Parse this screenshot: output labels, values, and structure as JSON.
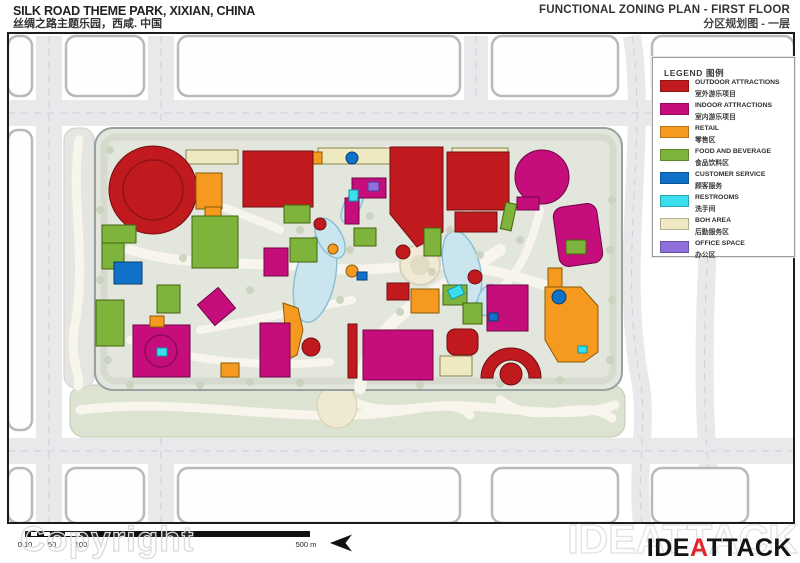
{
  "header": {
    "left_title_en": "SILK ROAD THEME PARK, XIXIAN, CHINA",
    "left_title_zh": "丝绸之路主题乐园，西咸. 中国",
    "right_title_en": "FUNCTIONAL ZONING PLAN - FIRST FLOOR",
    "right_title_zh": "分区规划图 - 一层"
  },
  "legend": {
    "title": "LEGEND 图例",
    "items": [
      {
        "zone": "outdoor",
        "label_en": "OUTDOOR ATTRACTIONS",
        "label_zh": "室外游乐项目"
      },
      {
        "zone": "indoor",
        "label_en": "INDOOR ATTRACTIONS",
        "label_zh": "室内游乐项目"
      },
      {
        "zone": "retail",
        "label_en": "RETAIL",
        "label_zh": "零售区"
      },
      {
        "zone": "fnb",
        "label_en": "FOOD AND BEVERAGE",
        "label_zh": "食品饮料区"
      },
      {
        "zone": "service",
        "label_en": "CUSTOMER SERVICE",
        "label_zh": "顾客服务"
      },
      {
        "zone": "restroom",
        "label_en": "RESTROOMS",
        "label_zh": "洗手间"
      },
      {
        "zone": "boh",
        "label_en": "BOH AREA",
        "label_zh": "后勤服务区"
      },
      {
        "zone": "office",
        "label_en": "OFFICE SPACE",
        "label_zh": "办公区"
      }
    ]
  },
  "zones": {
    "outdoor": {
      "fill": "#c11a1e",
      "stroke": "#6f0f11"
    },
    "indoor": {
      "fill": "#c50d7b",
      "stroke": "#6e0545"
    },
    "retail": {
      "fill": "#f5991f",
      "stroke": "#8a5a08"
    },
    "fnb": {
      "fill": "#7eb43b",
      "stroke": "#44650f"
    },
    "service": {
      "fill": "#0f72c8",
      "stroke": "#073f73"
    },
    "restroom": {
      "fill": "#3adeec",
      "stroke": "#0d96a5"
    },
    "boh": {
      "fill": "#efe9c1",
      "stroke": "#8a8454"
    },
    "office": {
      "fill": "#8f6fdb",
      "stroke": "#4f3795"
    }
  },
  "scale_bar": {
    "bar": {
      "x1": 25,
      "x2": 310,
      "y": 531,
      "h": 6,
      "notches": [
        [
          31,
          37
        ],
        [
          44,
          50
        ],
        [
          65,
          80
        ]
      ]
    },
    "labels": [
      {
        "text": "0 10",
        "x": 25
      },
      {
        "text": "50",
        "x": 52
      },
      {
        "text": "100",
        "x": 81
      },
      {
        "text": "500 m",
        "x": 306
      }
    ]
  },
  "footer": {
    "copyright_watermark": "Copyright",
    "logo_watermark": "IDEATTACK",
    "logo": {
      "prefix": "IDE",
      "accent": "A",
      "suffix": "TTACK"
    }
  },
  "map": {
    "colors": {
      "frame": "#1c1c1c",
      "road": "#e9e9eb",
      "road_dash": "#cfcfd4",
      "block_fill": "#fefefe",
      "block_stroke": "#b7b9bc",
      "park_fill": "#e3e6dc",
      "park_stroke": "#98a0a0",
      "park_ring": "#d6dacf",
      "strip": "#dde3d1",
      "strip_left": "#e5e5e2",
      "swirl": "#f8f5ec",
      "lake_fill": "#cbe5ef",
      "lake_stroke": "#8cc0d6",
      "walk": "#f8f5ee",
      "plaza_fill": "#efe9d6",
      "plaza_stroke": "#d9d2ba",
      "tree": "#c9d2bb",
      "sunburst": "#efe8d2"
    },
    "frame": {
      "x": 8,
      "y": 33,
      "w": 786,
      "h": 490
    },
    "roads_h": [
      {
        "x": 8,
        "y": 100,
        "w": 786,
        "h": 26
      },
      {
        "x": 8,
        "y": 438,
        "w": 786,
        "h": 26
      }
    ],
    "roads_v": [
      {
        "x": 36,
        "y": 36,
        "w": 26,
        "h": 487
      },
      {
        "x": 148,
        "y": 36,
        "w": 26,
        "h": 90
      },
      {
        "x": 148,
        "y": 438,
        "w": 26,
        "h": 85
      },
      {
        "x": 464,
        "y": 36,
        "w": 24,
        "h": 64
      }
    ],
    "roads_curvy": [
      "M632,36 C648,140 618,260 640,380 C648,420 636,470 642,523",
      "M706,36 C726,160 688,320 714,523"
    ],
    "blocks": [
      {
        "x": 8,
        "y": 36,
        "w": 24,
        "h": 60
      },
      {
        "x": 66,
        "y": 36,
        "w": 78,
        "h": 60
      },
      {
        "x": 178,
        "y": 36,
        "w": 282,
        "h": 60
      },
      {
        "x": 492,
        "y": 36,
        "w": 126,
        "h": 60
      },
      {
        "x": 652,
        "y": 36,
        "w": 142,
        "h": 60
      },
      {
        "x": 8,
        "y": 130,
        "w": 24,
        "h": 300
      },
      {
        "x": 8,
        "y": 468,
        "w": 24,
        "h": 55
      },
      {
        "x": 66,
        "y": 468,
        "w": 78,
        "h": 55
      },
      {
        "x": 178,
        "y": 468,
        "w": 282,
        "h": 55
      },
      {
        "x": 492,
        "y": 468,
        "w": 126,
        "h": 55
      },
      {
        "x": 652,
        "y": 468,
        "w": 96,
        "h": 55
      }
    ],
    "park": {
      "x": 95,
      "y": 128,
      "w": 527,
      "h": 262,
      "r": 18
    },
    "strip_bottom": {
      "x": 70,
      "y": 385,
      "w": 555,
      "h": 52
    },
    "strip_left": {
      "x": 64,
      "y": 128,
      "w": 30,
      "h": 260
    },
    "sunburst": {
      "cx": 337,
      "cy": 406,
      "rx": 20,
      "ry": 22
    },
    "swirls": [
      "M80,410 C200,395 300,430 420,408 C480,398 560,425 615,405",
      "M340,392 C380,430 450,390 470,415",
      "M500,400 C540,430 580,395 612,418",
      "M79,140 C70,200 88,260 74,330 C70,360 82,380 78,386"
    ],
    "walks": [
      {
        "d": "M360,388 C365,350 380,330 420,300 C450,280 470,270 500,250",
        "w": 12
      },
      {
        "d": "M130,250 C200,270 260,260 320,268 C360,272 390,268 420,265",
        "w": 10
      },
      {
        "d": "M420,265 C460,262 500,270 560,290",
        "w": 10
      },
      {
        "d": "M420,265 C420,220 400,180 390,150",
        "w": 10
      },
      {
        "d": "M200,330 C260,320 300,310 352,300",
        "w": 8
      },
      {
        "d": "M480,180 C470,220 450,240 432,256",
        "w": 8
      },
      {
        "d": "M540,210 C530,250 520,270 500,290",
        "w": 8
      },
      {
        "d": "M160,180 C200,200 240,212 280,230",
        "w": 8
      },
      {
        "d": "M130,340 C180,360 260,368 330,362",
        "w": 8
      }
    ],
    "lakes": [
      {
        "cx": 315,
        "cy": 278,
        "rx": 20,
        "ry": 45,
        "rot": 12
      },
      {
        "cx": 330,
        "cy": 238,
        "rx": 12,
        "ry": 22,
        "rot": -30
      },
      {
        "cx": 462,
        "cy": 268,
        "rx": 18,
        "ry": 38,
        "rot": -14
      },
      {
        "cx": 488,
        "cy": 300,
        "rx": 10,
        "ry": 16,
        "rot": 20
      },
      {
        "cx": 352,
        "cy": 206,
        "rx": 8,
        "ry": 18,
        "rot": 28
      }
    ],
    "plaza": {
      "cx": 420,
      "cy": 265,
      "r": 20,
      "r2": 10
    },
    "trees": [
      [
        110,
        150
      ],
      [
        100,
        210
      ],
      [
        100,
        280
      ],
      [
        108,
        360
      ],
      [
        130,
        385
      ],
      [
        200,
        385
      ],
      [
        250,
        382
      ],
      [
        300,
        383
      ],
      [
        420,
        385
      ],
      [
        500,
        384
      ],
      [
        560,
        380
      ],
      [
        610,
        360
      ],
      [
        612,
        300
      ],
      [
        610,
        250
      ],
      [
        612,
        200
      ],
      [
        300,
        230
      ],
      [
        340,
        300
      ],
      [
        400,
        312
      ],
      [
        432,
        272
      ],
      [
        480,
        255
      ],
      [
        250,
        290
      ],
      [
        350,
        250
      ],
      [
        370,
        216
      ],
      [
        450,
        230
      ],
      [
        520,
        240
      ],
      [
        560,
        226
      ],
      [
        183,
        258
      ],
      [
        225,
        305
      ]
    ],
    "buildings": [
      {
        "z": "boh",
        "s": "rect",
        "x": 186,
        "y": 150,
        "w": 52,
        "h": 14
      },
      {
        "z": "boh",
        "s": "rect",
        "x": 318,
        "y": 148,
        "w": 88,
        "h": 16
      },
      {
        "z": "boh",
        "s": "rect",
        "x": 452,
        "y": 148,
        "w": 56,
        "h": 16
      },
      {
        "z": "office",
        "s": "rect",
        "x": 394,
        "y": 150,
        "w": 9,
        "h": 8
      },
      {
        "z": "office",
        "s": "rect",
        "x": 540,
        "y": 151,
        "w": 8,
        "h": 7
      },
      {
        "z": "retail",
        "s": "rect",
        "x": 310,
        "y": 152,
        "w": 12,
        "h": 12
      },
      {
        "z": "service",
        "s": "circle",
        "cx": 352,
        "cy": 158,
        "r": 6
      },
      {
        "z": "outdoor",
        "s": "circle",
        "cx": 153,
        "cy": 190,
        "r": 44
      },
      {
        "z": "outdoor",
        "s": "ring",
        "cx": 153,
        "cy": 190,
        "r": 30
      },
      {
        "z": "retail",
        "s": "rect",
        "x": 196,
        "y": 173,
        "w": 26,
        "h": 36
      },
      {
        "z": "retail",
        "s": "rect",
        "x": 205,
        "y": 207,
        "w": 16,
        "h": 16
      },
      {
        "z": "outdoor",
        "s": "rect",
        "x": 243,
        "y": 151,
        "w": 70,
        "h": 56
      },
      {
        "z": "outdoor",
        "s": "poly",
        "pts": "390,147 443,147 443,232 417,247 390,214"
      },
      {
        "z": "outdoor",
        "s": "rect",
        "x": 447,
        "y": 152,
        "w": 62,
        "h": 58
      },
      {
        "z": "outdoor",
        "s": "rect",
        "x": 455,
        "y": 212,
        "w": 42,
        "h": 20
      },
      {
        "z": "indoor",
        "s": "circle",
        "cx": 542,
        "cy": 177,
        "r": 27
      },
      {
        "z": "indoor",
        "s": "rect",
        "x": 517,
        "y": 197,
        "w": 22,
        "h": 13
      },
      {
        "z": "indoor",
        "s": "rect",
        "x": 556,
        "y": 205,
        "w": 44,
        "h": 60,
        "rx": 10,
        "rot": -8
      },
      {
        "z": "fnb",
        "s": "rect",
        "x": 503,
        "y": 203,
        "w": 11,
        "h": 27,
        "rot": 12
      },
      {
        "z": "retail",
        "s": "rect",
        "x": 548,
        "y": 268,
        "w": 14,
        "h": 20
      },
      {
        "z": "indoor",
        "s": "rect",
        "x": 352,
        "y": 178,
        "w": 34,
        "h": 20
      },
      {
        "z": "indoor",
        "s": "rect",
        "x": 345,
        "y": 198,
        "w": 14,
        "h": 26
      },
      {
        "z": "office",
        "s": "rect",
        "x": 368,
        "y": 182,
        "w": 11,
        "h": 9
      },
      {
        "z": "restroom",
        "s": "rect",
        "x": 349,
        "y": 190,
        "w": 9,
        "h": 11
      },
      {
        "z": "fnb",
        "s": "rect",
        "x": 424,
        "y": 228,
        "w": 17,
        "h": 28
      },
      {
        "z": "fnb",
        "s": "rect",
        "x": 290,
        "y": 238,
        "w": 27,
        "h": 24
      },
      {
        "z": "fnb",
        "s": "rect",
        "x": 354,
        "y": 228,
        "w": 22,
        "h": 18
      },
      {
        "z": "indoor",
        "s": "rect",
        "x": 264,
        "y": 248,
        "w": 24,
        "h": 28
      },
      {
        "z": "restroom",
        "s": "rect",
        "x": 219,
        "y": 223,
        "w": 12,
        "h": 9
      },
      {
        "z": "outdoor",
        "s": "rect",
        "x": 210,
        "y": 233,
        "w": 16,
        "h": 12
      },
      {
        "z": "outdoor",
        "s": "circle",
        "cx": 320,
        "cy": 224,
        "r": 6
      },
      {
        "z": "outdoor",
        "s": "circle",
        "cx": 403,
        "cy": 252,
        "r": 7
      },
      {
        "z": "outdoor",
        "s": "circle",
        "cx": 475,
        "cy": 277,
        "r": 7
      },
      {
        "z": "outdoor",
        "s": "circle",
        "cx": 118,
        "cy": 316,
        "r": 6
      },
      {
        "z": "fnb",
        "s": "rect",
        "x": 102,
        "y": 225,
        "w": 34,
        "h": 18
      },
      {
        "z": "fnb",
        "s": "rect",
        "x": 102,
        "y": 243,
        "w": 22,
        "h": 26
      },
      {
        "z": "fnb",
        "s": "rect",
        "x": 192,
        "y": 216,
        "w": 46,
        "h": 52
      },
      {
        "z": "service",
        "s": "rect",
        "x": 114,
        "y": 262,
        "w": 28,
        "h": 22
      },
      {
        "z": "retail",
        "s": "circle",
        "cx": 352,
        "cy": 271,
        "r": 6
      },
      {
        "z": "retail",
        "s": "circle",
        "cx": 333,
        "cy": 249,
        "r": 5
      },
      {
        "z": "service",
        "s": "rect",
        "x": 357,
        "y": 272,
        "w": 10,
        "h": 8
      },
      {
        "z": "fnb",
        "s": "rect",
        "x": 443,
        "y": 285,
        "w": 24,
        "h": 20
      },
      {
        "z": "fnb",
        "s": "rect",
        "x": 566,
        "y": 240,
        "w": 20,
        "h": 14
      },
      {
        "z": "indoor",
        "s": "rect",
        "x": 133,
        "y": 325,
        "w": 57,
        "h": 52
      },
      {
        "z": "indoor",
        "s": "ring",
        "cx": 161,
        "cy": 351,
        "r": 16
      },
      {
        "z": "restroom",
        "s": "rect",
        "x": 157,
        "y": 348,
        "w": 10,
        "h": 8
      },
      {
        "z": "fnb",
        "s": "rect",
        "x": 96,
        "y": 300,
        "w": 28,
        "h": 46
      },
      {
        "z": "fnb",
        "s": "rect",
        "x": 157,
        "y": 285,
        "w": 23,
        "h": 28
      },
      {
        "z": "retail",
        "s": "rect",
        "x": 150,
        "y": 316,
        "w": 14,
        "h": 11
      },
      {
        "z": "indoor",
        "s": "rect",
        "x": 203,
        "y": 293,
        "w": 27,
        "h": 27,
        "rot": -40
      },
      {
        "z": "retail",
        "s": "poly",
        "pts": "283,303 298,308 303,330 297,355 283,362 276,344 285,326"
      },
      {
        "z": "indoor",
        "s": "rect",
        "x": 260,
        "y": 323,
        "w": 30,
        "h": 54
      },
      {
        "z": "retail",
        "s": "rect",
        "x": 221,
        "y": 363,
        "w": 18,
        "h": 14
      },
      {
        "z": "outdoor",
        "s": "circle",
        "cx": 311,
        "cy": 347,
        "r": 9
      },
      {
        "z": "outdoor",
        "s": "rect",
        "x": 348,
        "y": 324,
        "w": 9,
        "h": 54
      },
      {
        "z": "indoor",
        "s": "rect",
        "x": 363,
        "y": 330,
        "w": 70,
        "h": 50
      },
      {
        "z": "boh",
        "s": "rect",
        "x": 440,
        "y": 356,
        "w": 32,
        "h": 20
      },
      {
        "z": "outdoor",
        "s": "rect",
        "x": 447,
        "y": 329,
        "w": 31,
        "h": 26,
        "rx": 8
      },
      {
        "z": "outdoor",
        "s": "rect",
        "x": 387,
        "y": 283,
        "w": 22,
        "h": 17
      },
      {
        "z": "retail",
        "s": "rect",
        "x": 411,
        "y": 289,
        "w": 28,
        "h": 24
      },
      {
        "z": "fnb",
        "s": "rect",
        "x": 463,
        "y": 303,
        "w": 19,
        "h": 21
      },
      {
        "z": "indoor",
        "s": "rect",
        "x": 487,
        "y": 285,
        "w": 41,
        "h": 46
      },
      {
        "z": "service",
        "s": "rect",
        "x": 489,
        "y": 313,
        "w": 9,
        "h": 8
      },
      {
        "z": "retail",
        "s": "poly",
        "pts": "545,287 581,287 598,306 598,352 584,362 558,362 545,340"
      },
      {
        "z": "service",
        "s": "circle",
        "cx": 559,
        "cy": 297,
        "r": 7
      },
      {
        "z": "restroom",
        "s": "rect",
        "x": 578,
        "y": 346,
        "w": 9,
        "h": 7
      },
      {
        "z": "outdoor",
        "s": "path",
        "d": "M481,378 A30,30 0 1 1 541,378 L529,378 A18,18 0 1 0 493,378 Z"
      },
      {
        "z": "outdoor",
        "s": "circle",
        "cx": 511,
        "cy": 374,
        "r": 11
      },
      {
        "z": "restroom",
        "s": "rect",
        "x": 449,
        "y": 287,
        "w": 14,
        "h": 10,
        "rot": -25
      },
      {
        "z": "fnb",
        "s": "rect",
        "x": 284,
        "y": 205,
        "w": 26,
        "h": 18
      }
    ]
  }
}
